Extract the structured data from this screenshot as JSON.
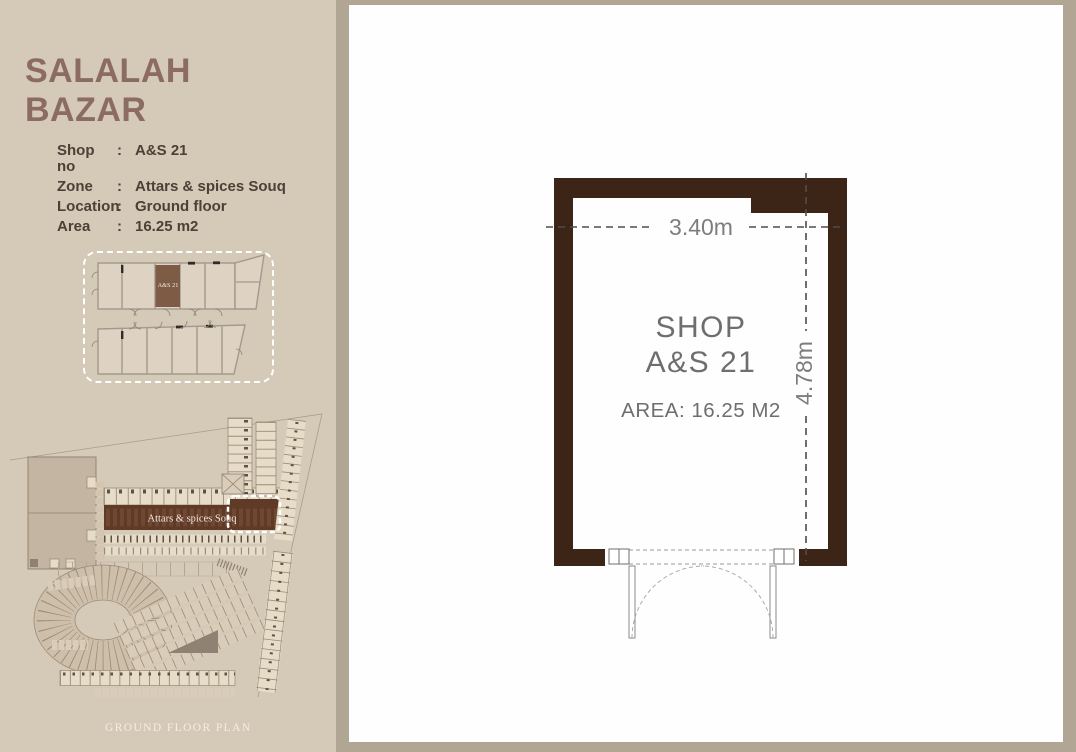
{
  "title": "SALALAH BAZAR",
  "details": {
    "rows": [
      {
        "label": "Shop no",
        "colon": ":",
        "value": "A&S 21"
      },
      {
        "label": "Zone",
        "colon": ":",
        "value": "Attars & spices Souq"
      },
      {
        "label": "Location",
        "colon": ":",
        "value": "Ground floor"
      },
      {
        "label": "Area",
        "colon": ":",
        "value": "16.25 m2"
      }
    ]
  },
  "inset_plan": {
    "highlighted_shop": "A&S 21"
  },
  "site_plan": {
    "zone_band_label": "Attars & spices Souq",
    "footer_label": "GROUND FLOOR PLAN"
  },
  "shop_plan": {
    "title_line1": "SHOP",
    "title_line2": "A&S 21",
    "area_text": "AREA: 16.25 M2",
    "dim_width": "3.40m",
    "dim_height": "4.78m"
  },
  "colors": {
    "page_bg": "#b1a694",
    "sidebar_bg": "#d5c9b7",
    "panel_bg": "#fefefe",
    "title_text": "#8c6c62",
    "details_text": "#4c4037",
    "wall_brown": "#3c2517",
    "zone_band_brown": "#5e3a27",
    "inset_highlight_brown": "#7d5b45",
    "dimension_text": "#7d7d7d",
    "shop_text": "#6e6e6e",
    "highlight_dash": "#ffffff"
  }
}
